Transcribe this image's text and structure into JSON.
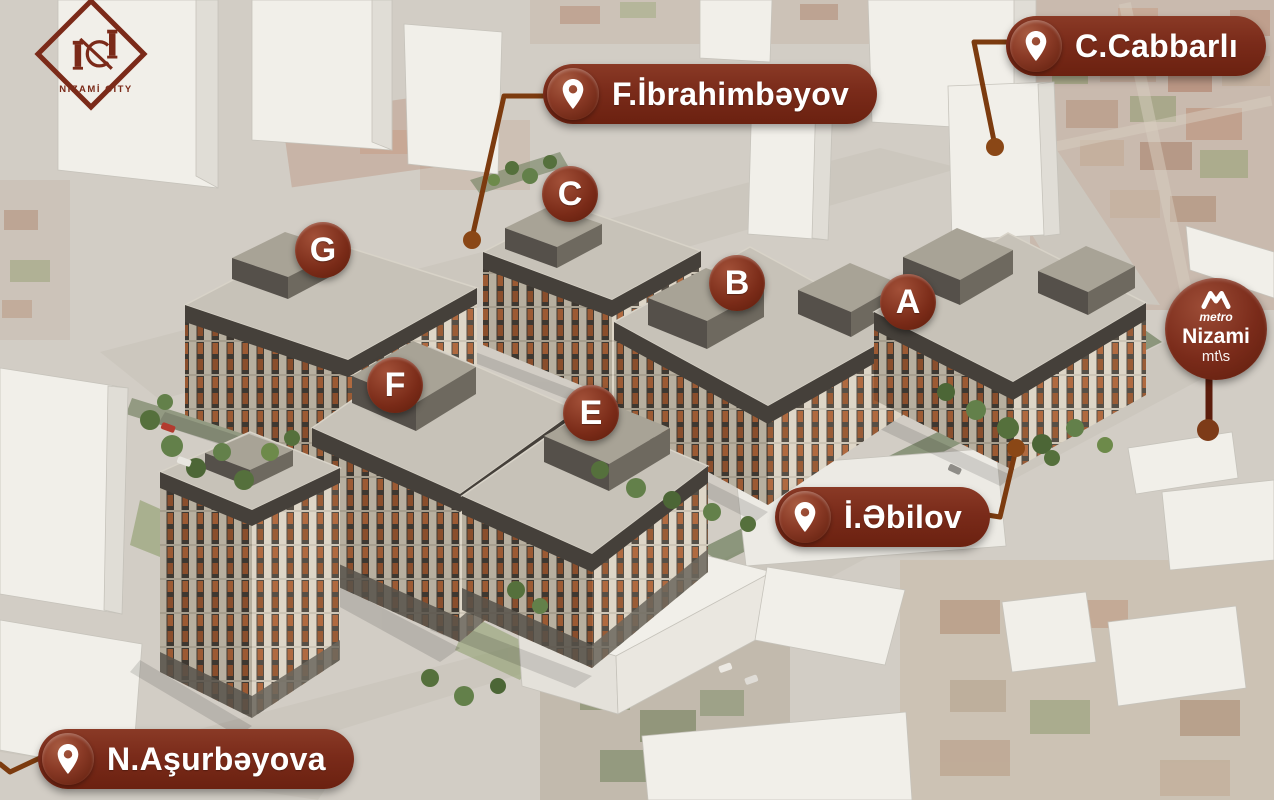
{
  "logo": {
    "title": "NİZAMİ CİTY"
  },
  "street_labels": {
    "ibrahimbayov": "F.İbrahimbəyov",
    "cabbarli": "C.Cabbarlı",
    "abilov": "İ.Əbilov",
    "asurbayova": "N.Aşurbəyova"
  },
  "buildings": {
    "g": "G",
    "c": "C",
    "b": "B",
    "a": "A",
    "f": "F",
    "e": "E"
  },
  "metro": {
    "brand": "metro",
    "station": "Nizami",
    "suffix": "mt\\s"
  },
  "colors": {
    "marker_maroon": "#7a2b1a",
    "connector_brown": "#7c3b0f",
    "facade_cream": "#ded6c7",
    "roof_gray": "#c7c2b8"
  }
}
